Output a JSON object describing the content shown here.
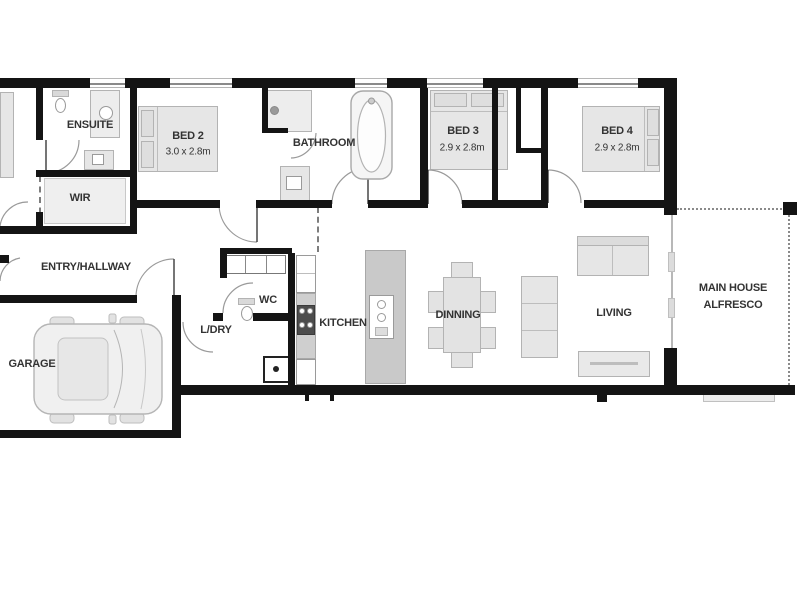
{
  "plan": {
    "type": "residential-floor-plan",
    "colors": {
      "wall": "#141414",
      "text": "#333333",
      "furniture_fill": "#e6e6e6",
      "furniture_border": "#b3b3b3",
      "island_fill": "#c9c9c9",
      "door_arc": "#9a9a9a"
    },
    "rooms": {
      "ensuite": {
        "label": "ENSUITE"
      },
      "bed2": {
        "label": "BED 2",
        "dims": "3.0 x 2.8m"
      },
      "wir": {
        "label": "WIR"
      },
      "bathroom": {
        "label": "BATHROOM"
      },
      "bed3": {
        "label": "BED 3",
        "dims": "2.9 x 2.8m"
      },
      "bed4": {
        "label": "BED 4",
        "dims": "2.9 x 2.8m"
      },
      "entry": {
        "label": "ENTRY/HALLWAY"
      },
      "wc": {
        "label": "WC"
      },
      "ldry": {
        "label": "L/DRY"
      },
      "kitchen": {
        "label": "KITCHEN"
      },
      "garage": {
        "label": "GARAGE"
      },
      "dinning": {
        "label": "DINNING"
      },
      "living": {
        "label": "LIVING"
      },
      "alfresco": {
        "label_line1": "MAIN HOUSE",
        "label_line2": "ALFRESCO"
      }
    }
  }
}
